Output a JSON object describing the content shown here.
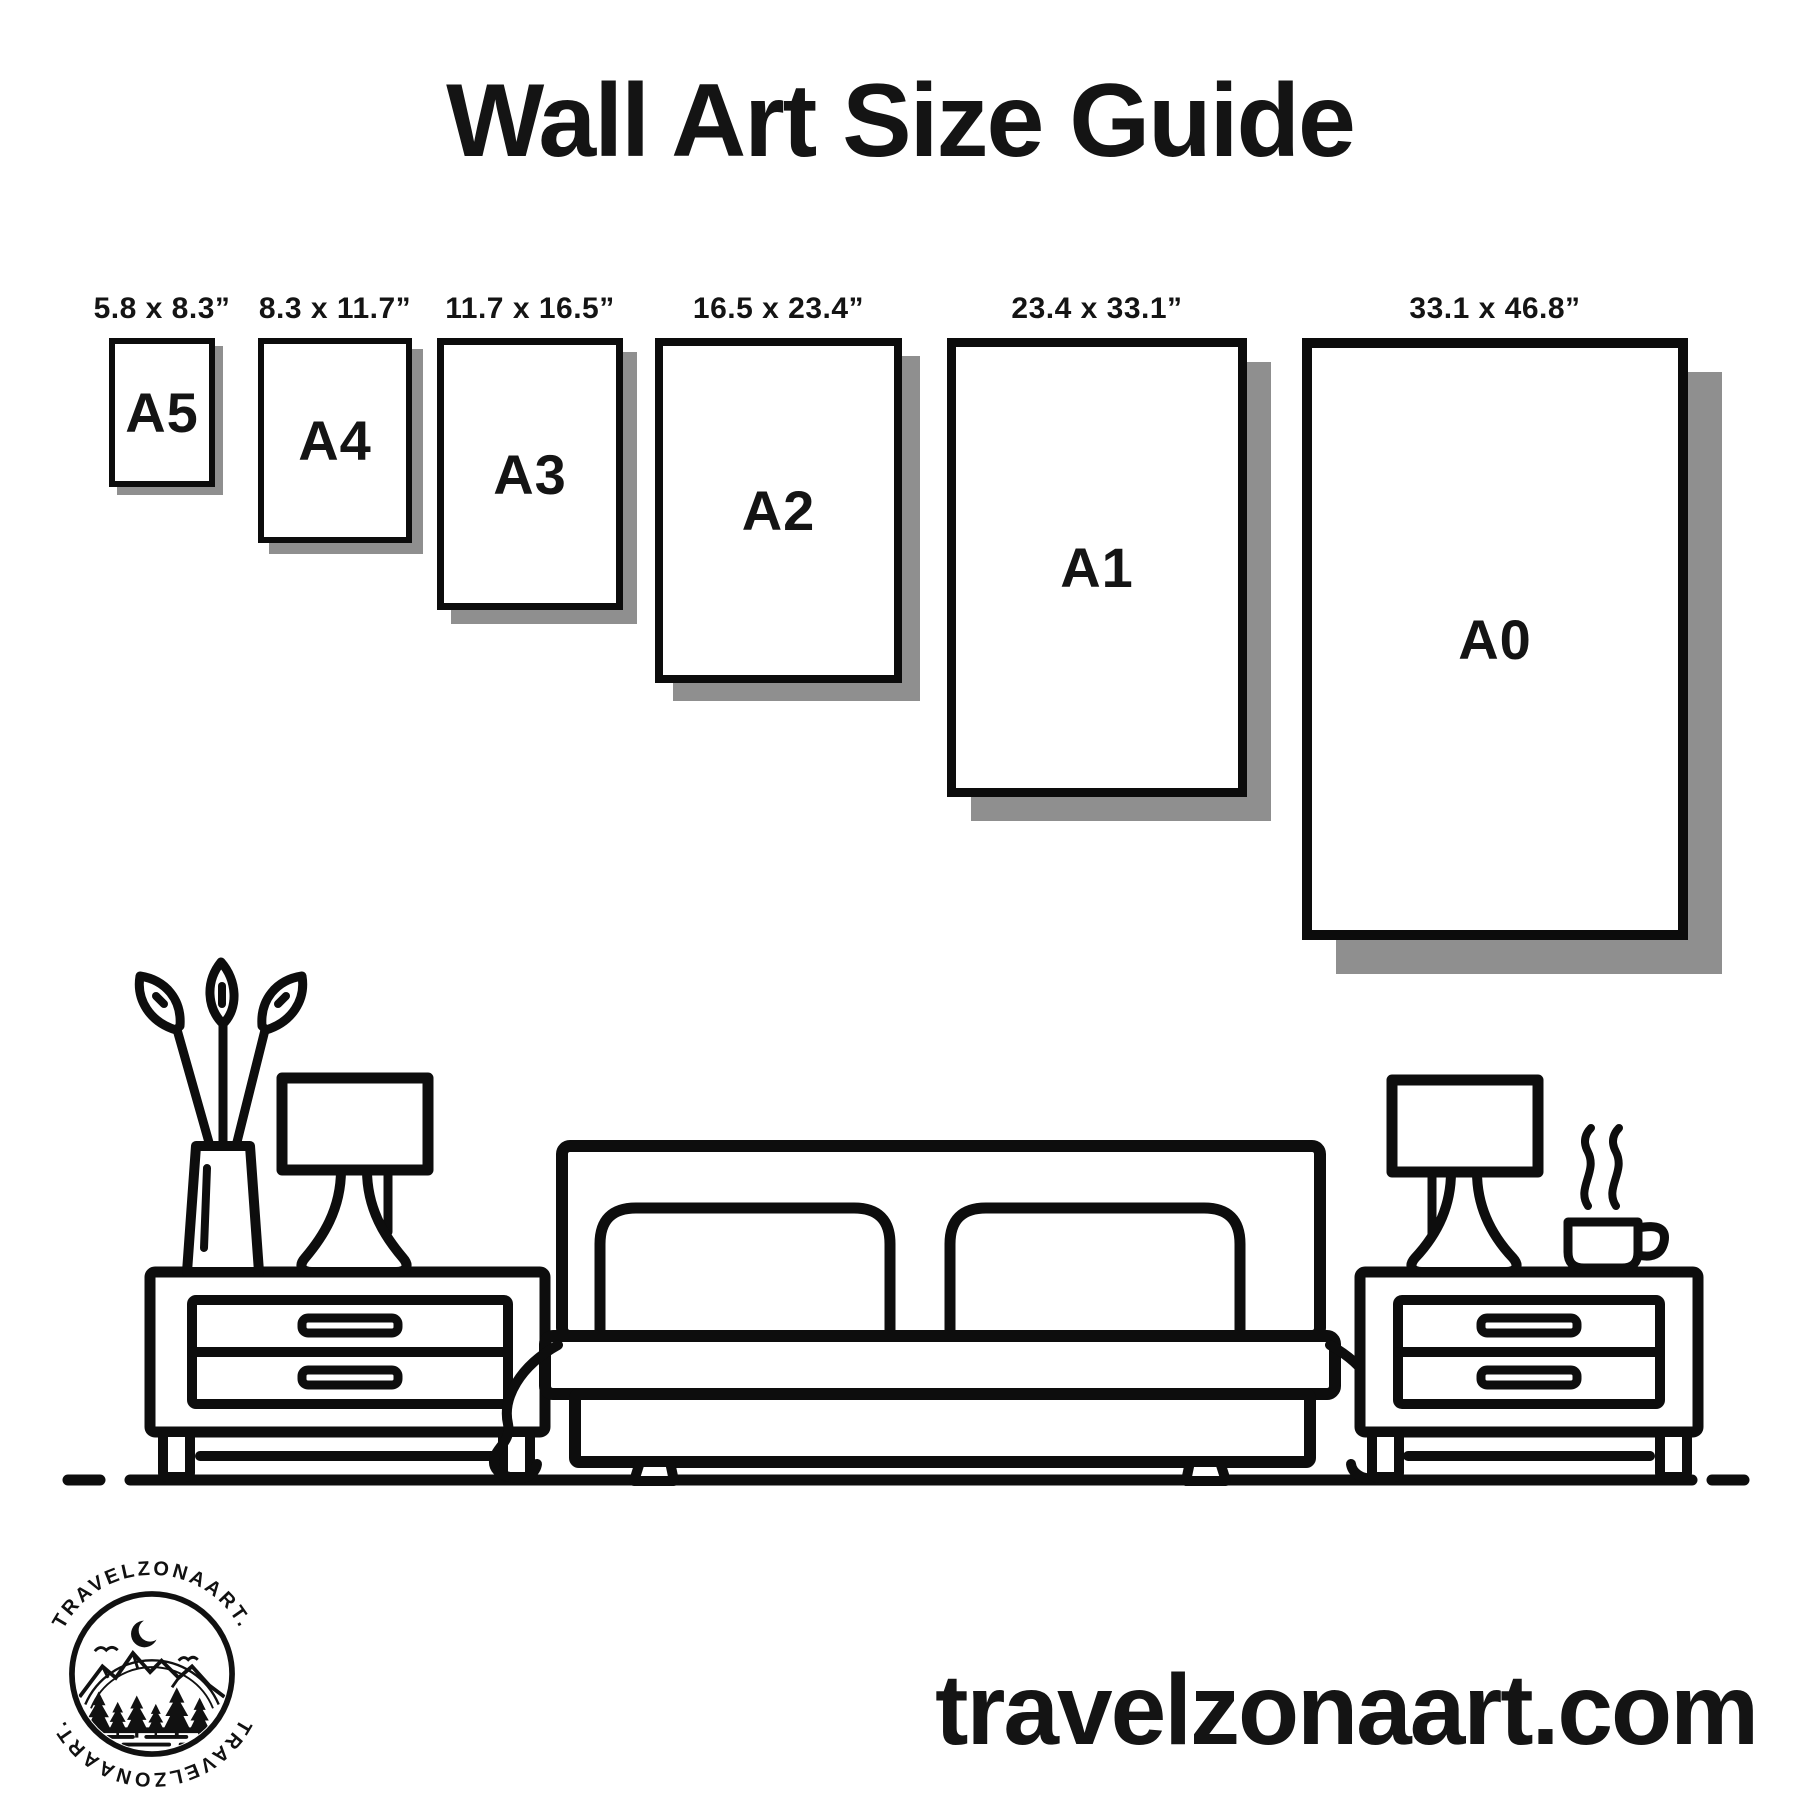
{
  "title": "Wall Art Size Guide",
  "sizes": [
    {
      "code": "A5",
      "dimensions": "5.8 x 8.3”"
    },
    {
      "code": "A4",
      "dimensions": "8.3 x 11.7”"
    },
    {
      "code": "A3",
      "dimensions": "11.7 x 16.5”"
    },
    {
      "code": "A2",
      "dimensions": "16.5 x 23.4”"
    },
    {
      "code": "A1",
      "dimensions": "23.4 x 33.1”"
    },
    {
      "code": "A0",
      "dimensions": "33.1 x 46.8”"
    }
  ],
  "logo": {
    "brand_top": "TRAVELZONAART.",
    "brand_bottom": "TRAVELZONAART.",
    "icons": [
      "crescent-moon-icon",
      "birds-icon",
      "mountains-icon",
      "pine-trees-icon",
      "water-icon"
    ]
  },
  "scene": {
    "icons": [
      "plant-vase-icon",
      "table-lamp-icon",
      "nightstand-icon",
      "bed-icon",
      "pillow-icon",
      "coffee-cup-icon",
      "steam-icon",
      "floor-line"
    ]
  },
  "footer": {
    "website": "travelzonaart.com"
  },
  "colors": {
    "ink": "#101010",
    "shadow": "#8f8f8f",
    "background": "#ffffff"
  }
}
